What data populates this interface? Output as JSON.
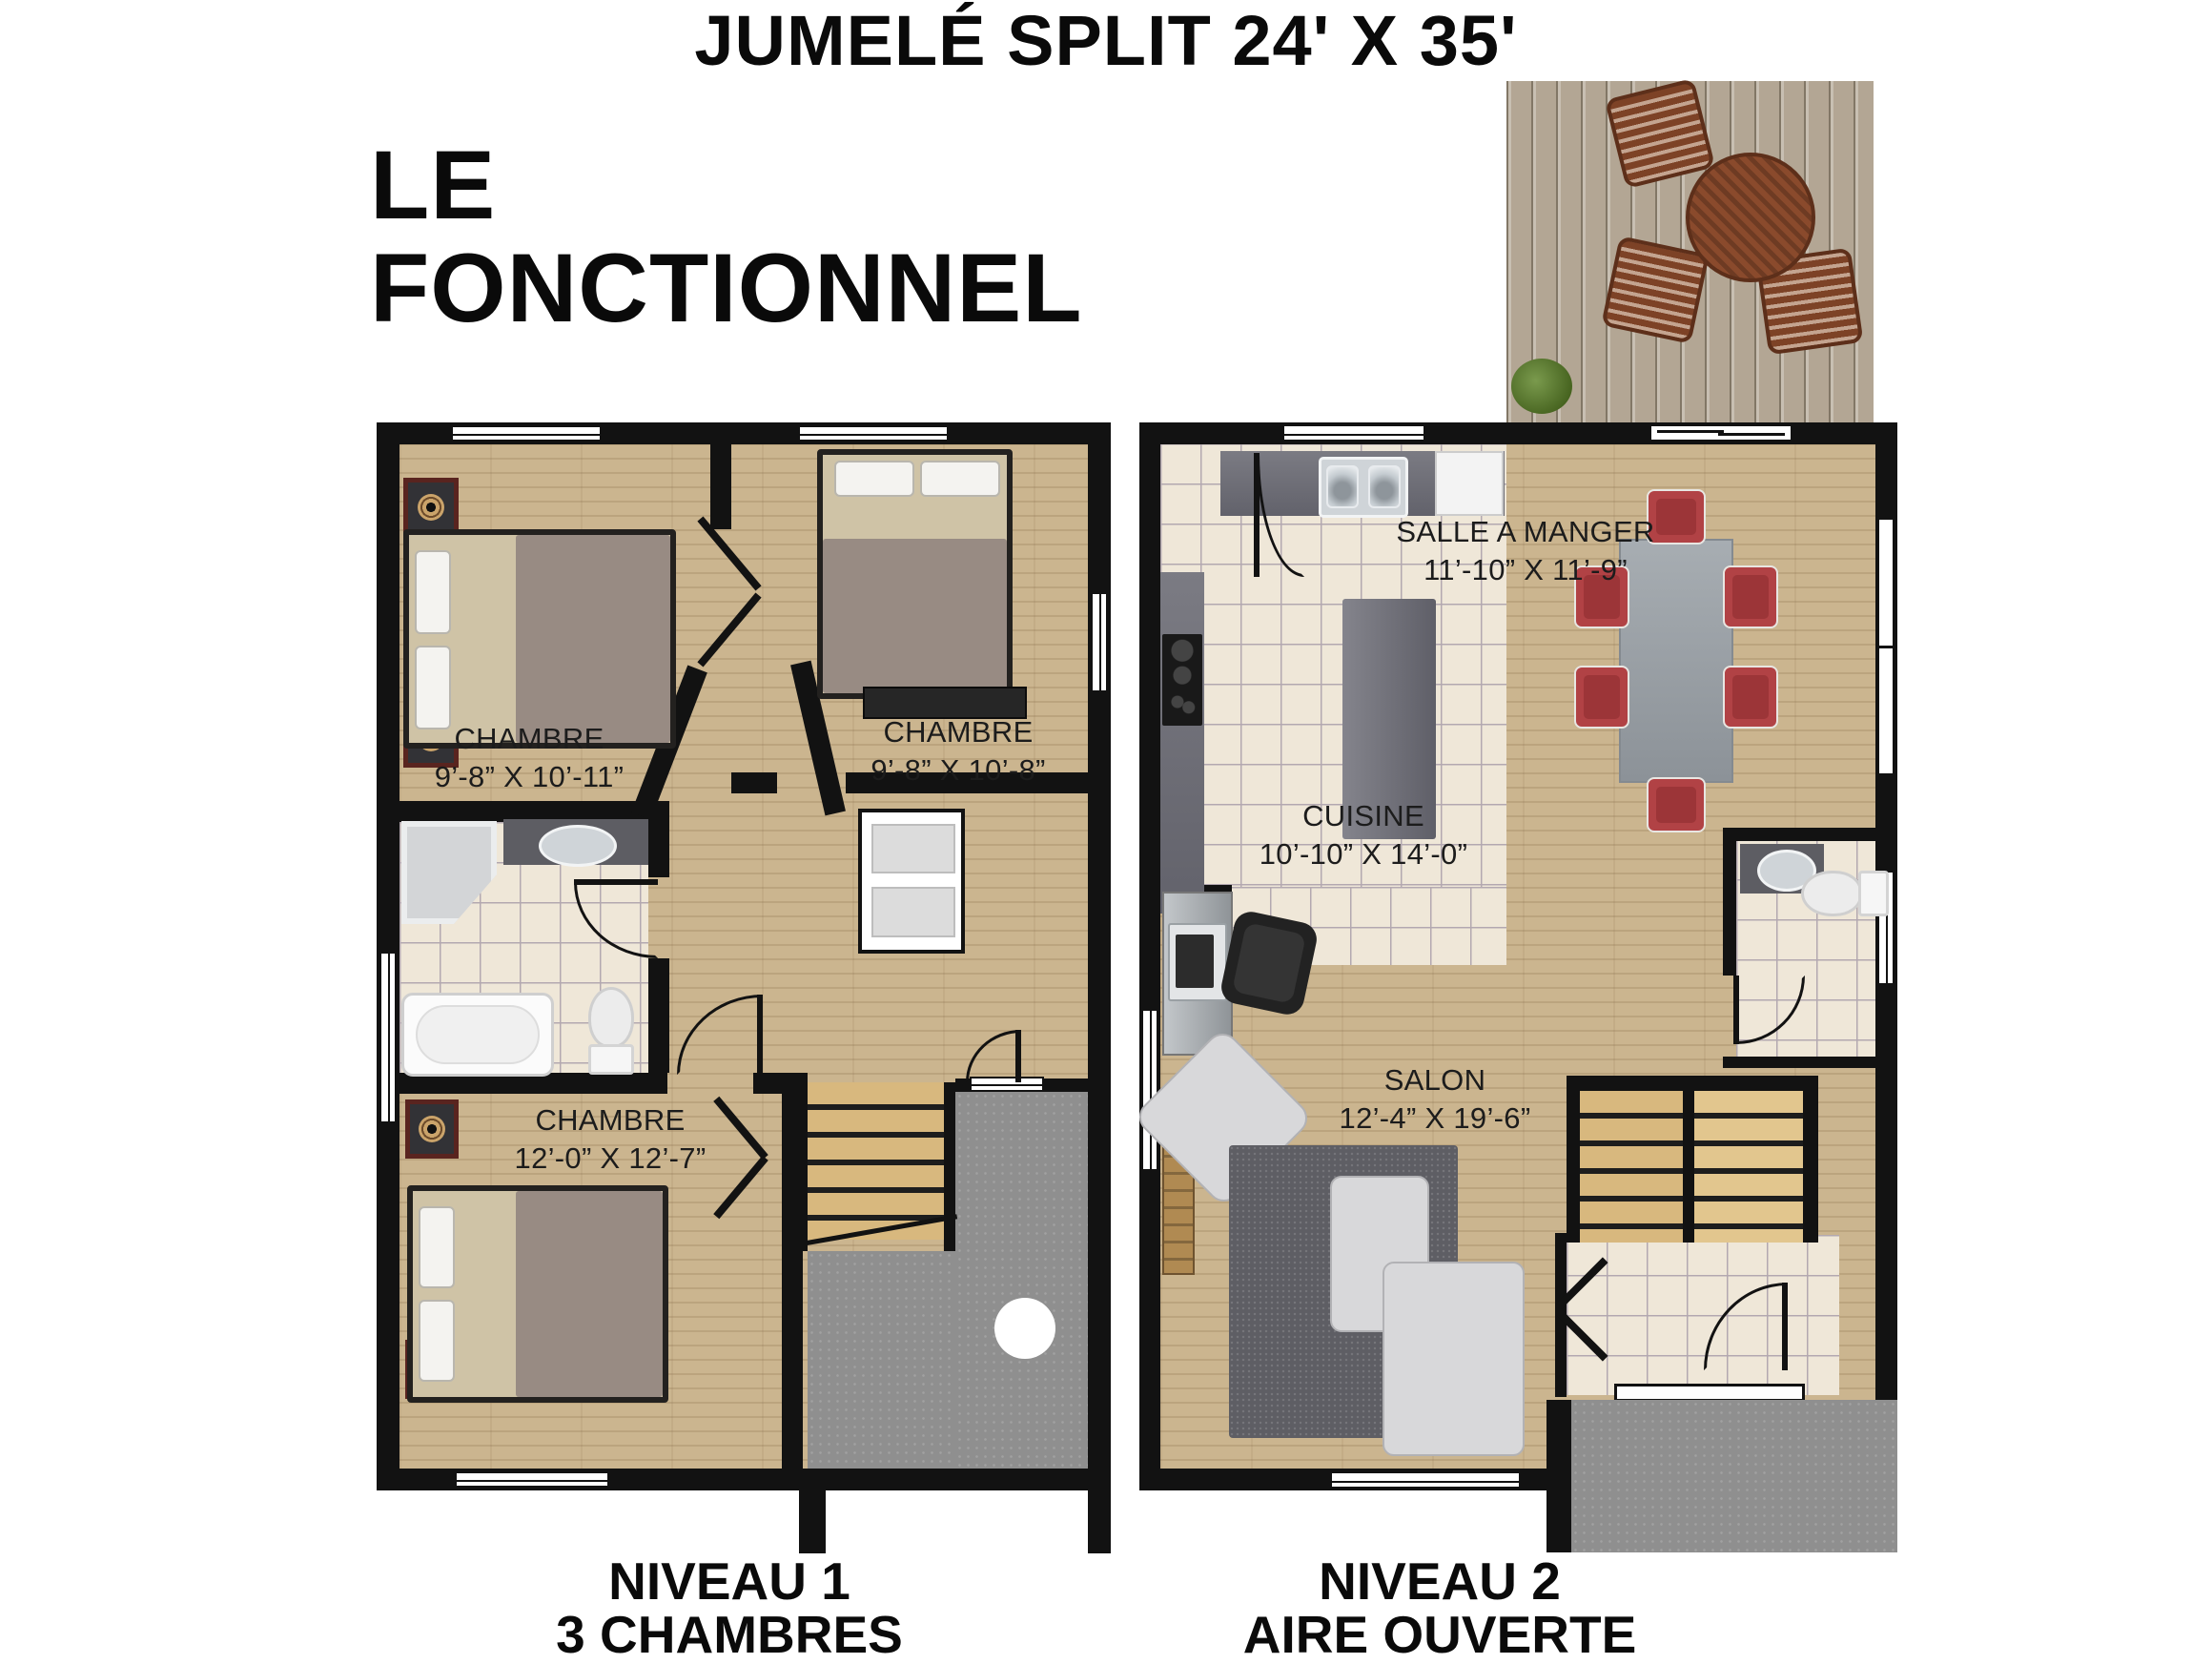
{
  "title": "JUMELÉ SPLIT 24' X 35'",
  "subtitle": {
    "line1": "LE",
    "line2": "FONCTIONNEL"
  },
  "level1": {
    "caption_line1": "NIVEAU 1",
    "caption_line2": "3 CHAMBRES",
    "rooms": [
      {
        "name": "CHAMBRE",
        "dims": "9’-8” X 10’-11”"
      },
      {
        "name": "CHAMBRE",
        "dims": "9’-8” X 10’-8”"
      },
      {
        "name": "CHAMBRE",
        "dims": "12’-0” X 12’-7”"
      }
    ]
  },
  "level2": {
    "caption_line1": "NIVEAU 2",
    "caption_line2": "AIRE OUVERTE",
    "rooms": [
      {
        "name": "SALLE A MANGER",
        "dims": "11’-10” X 11’-9”"
      },
      {
        "name": "CUISINE",
        "dims": "10’-10” X 14’-0”"
      },
      {
        "name": "SALON",
        "dims": "12’-4” X 19’-6”"
      }
    ]
  },
  "colors": {
    "wall": "#121212",
    "wood": "#cbb58f",
    "tile": "#efe7d8",
    "tile_line": "#b3a8b0",
    "concrete": "#8f8f8f",
    "counter": "#71717b",
    "red": "#b14245",
    "rug": "#5e5e64",
    "sofa": "#d8d8da",
    "stair": "#d8b87e",
    "deck": "#b3a694",
    "ink": "#141414"
  }
}
